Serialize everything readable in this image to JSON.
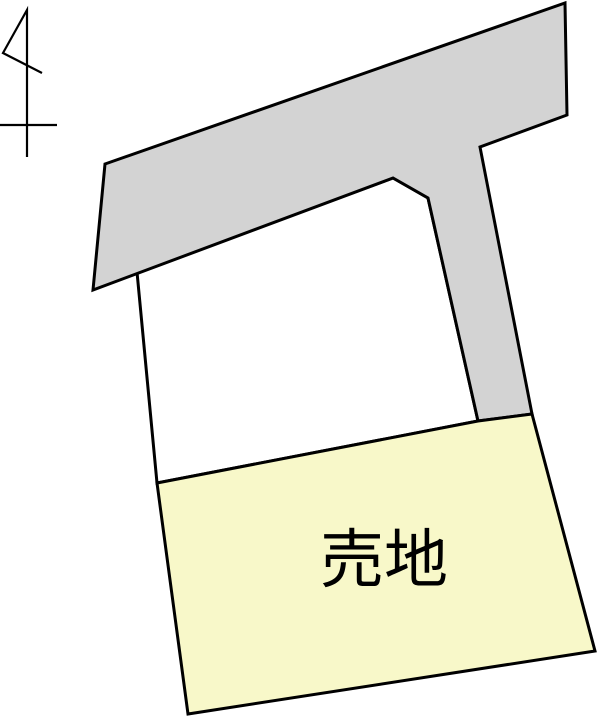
{
  "map": {
    "width": 600,
    "height": 718,
    "background": "#ffffff"
  },
  "colors": {
    "road_fill": "#d3d3d3",
    "sale_parcel_fill": "#f8f8c9",
    "vacant_parcel_fill": "#ffffff",
    "outline": "#000000",
    "label_text": "#000000"
  },
  "labels": {
    "sale_land": "売地"
  },
  "label_layout": {
    "x": 384,
    "y": 582,
    "font_size": 64
  },
  "shapes": {
    "road_points": "105,164 565,3 567,115 480,147 532,414 478,421 428,198 393,178 93,290",
    "vacant_parcel_points": "137,272 393,178 428,198 478,421 157,483",
    "sale_parcel_points": "157,483 478,421 532,414 595,651 188,714",
    "north_arrow_path": "M27,157 L27,10 L3,53 L42,73 M0,125 L57,125"
  }
}
